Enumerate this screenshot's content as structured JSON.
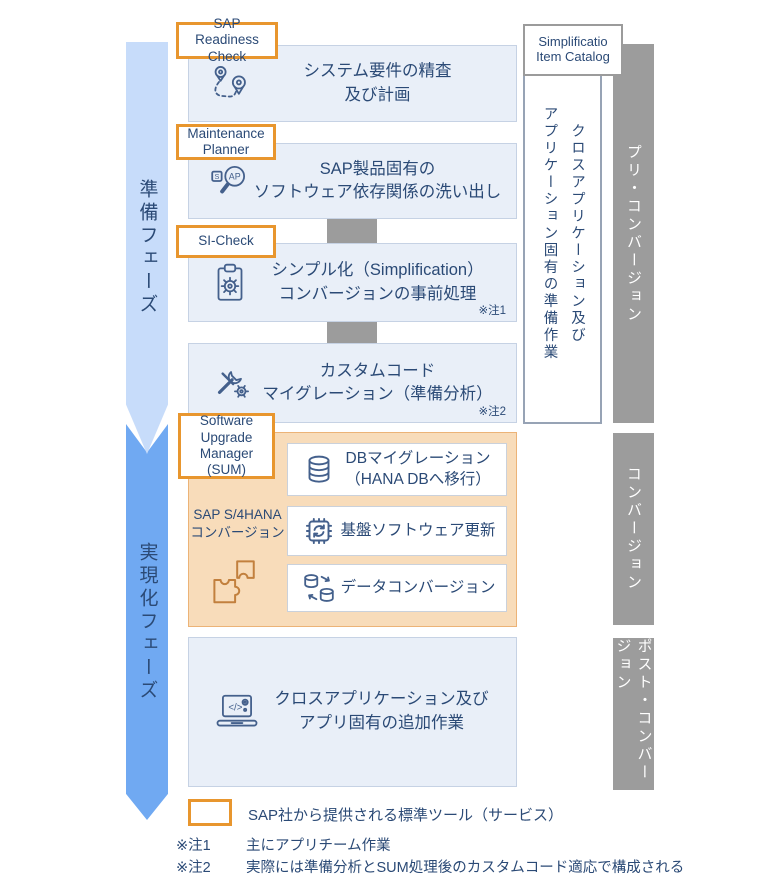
{
  "phases": {
    "prep": "準備フェーズ",
    "realization": "実現化フェーズ"
  },
  "tool_labels": {
    "readiness": "SAP Readiness Check",
    "maintenance": "Maintenance Planner",
    "si_check": "SI-Check",
    "sum": "Software Upgrade Manager (SUM)",
    "simplification_catalog": "Simplificatio Item Catalog"
  },
  "flow": {
    "boxes": [
      {
        "line1": "システム要件の精査",
        "line2": "及び計画",
        "note": ""
      },
      {
        "line1": "SAP製品固有の",
        "line2": "ソフトウェア依存関係の洗い出し",
        "note": ""
      },
      {
        "line1": "シンプル化（Simplification）",
        "line2": "コンバージョンの事前処理",
        "note": "※注1"
      },
      {
        "line1": "カスタムコード",
        "line2": "マイグレーション（準備分析）",
        "note": "※注2"
      }
    ]
  },
  "conversion": {
    "side_label_line1": "SAP S/4HANA",
    "side_label_line2": "コンバージョン",
    "boxes": [
      {
        "line1": "DBマイグレーション",
        "line2": "（HANA DBへ移行）"
      },
      {
        "line1": "基盤ソフトウェア更新",
        "line2": ""
      },
      {
        "line1": "データコンバージョン",
        "line2": ""
      }
    ]
  },
  "post_box": {
    "line1": "クロスアプリケーション及び",
    "line2": "アプリ固有の追加作業"
  },
  "right_panel": {
    "vertical_note_line1": "クロスアプリケーション及び",
    "vertical_note_line2": "アプリケーション固有の準備作業",
    "bars": [
      {
        "label": "プリ・コンバージョン"
      },
      {
        "label": "コンバージョン"
      },
      {
        "label": "ポスト・コンバージョン"
      }
    ]
  },
  "legend": {
    "box_label": "SAP社から提供される標準ツール（サービス）",
    "notes": [
      {
        "label": "※注1",
        "text": "主にアプリチーム作業"
      },
      {
        "label": "※注2",
        "text": "実際には準備分析とSUM処理後のカスタムコード適応で構成される"
      }
    ]
  },
  "colors": {
    "accent_orange": "#E8962E",
    "conversion_bg": "#F8DCBA",
    "conversion_border": "#ECB377",
    "flow_box_bg": "#E9EFF8",
    "flow_box_border": "#C6D2E4",
    "prep_arrow_blue": "#C7DCFA",
    "realization_arrow_blue": "#70A9F2",
    "bar_gray": "#9C9C9C",
    "text_navy": "#2B4A76",
    "icon_stroke": "#44608C",
    "puzzle_stroke": "#C2803E"
  }
}
